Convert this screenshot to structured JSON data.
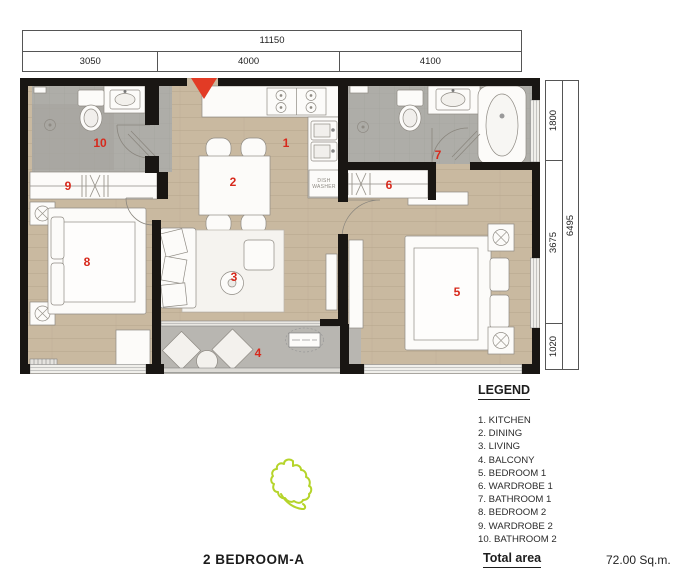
{
  "dimensions": {
    "top": {
      "total": "11150",
      "segments": [
        "3050",
        "4000",
        "4100"
      ]
    },
    "right": {
      "total": "6495",
      "segments": [
        "1800",
        "3675",
        "1020"
      ]
    }
  },
  "plan": {
    "rooms": [
      {
        "number": "1",
        "name": "KITCHEN"
      },
      {
        "number": "2",
        "name": "DINING"
      },
      {
        "number": "3",
        "name": "LIVING"
      },
      {
        "number": "4",
        "name": "BALCONY"
      },
      {
        "number": "5",
        "name": "BEDROOM 1"
      },
      {
        "number": "6",
        "name": "WARDROBE 1"
      },
      {
        "number": "7",
        "name": "BATHROOM 1"
      },
      {
        "number": "8",
        "name": "BEDROOM 2"
      },
      {
        "number": "9",
        "name": "WARDROBE 2"
      },
      {
        "number": "10",
        "name": "BATHROOM 2"
      }
    ],
    "appliance_labels": {
      "dishwasher": "DISH WASHER"
    }
  },
  "legend": {
    "title": "LEGEND",
    "items": [
      "1. KITCHEN",
      "2. DINING",
      "3. LIVING",
      "4. BALCONY",
      "5. BEDROOM 1",
      "6. WARDROBE 1",
      "7. BATHROOM 1",
      "8. BEDROOM 2",
      "9. WARDROBE 2",
      "10. BATHROOM 2"
    ]
  },
  "footer": {
    "plan_title": "2 BEDROOM-A",
    "total_area_label": "Total area",
    "total_area_value": "72.00 Sq.m."
  },
  "colors": {
    "accent_red": "#d7291c",
    "wall_black": "#191613",
    "wood_floor": "#c9b9a0",
    "tile_gray": "#aeada8",
    "balcony_gray": "#b8b6b1",
    "highlight_green": "#b5d42a"
  }
}
